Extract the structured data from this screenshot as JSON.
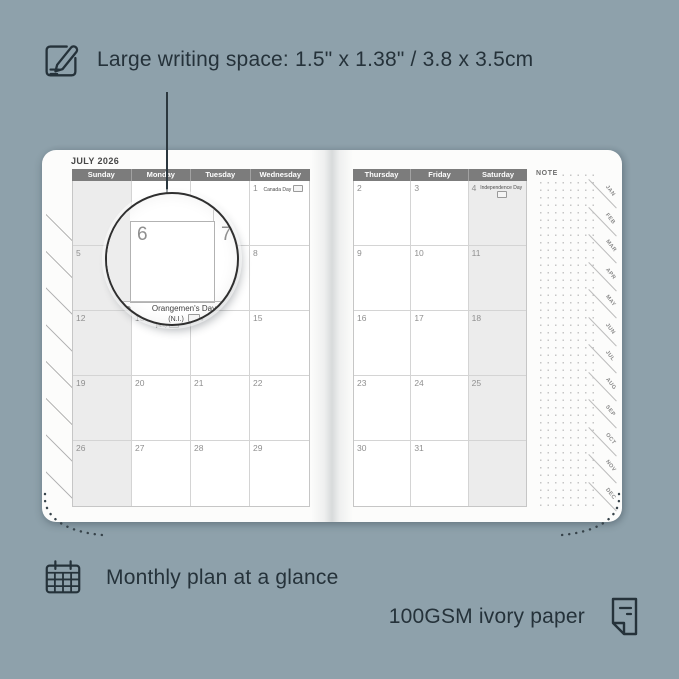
{
  "colors": {
    "background": "#8ea1ab",
    "page": "#fcfcfb",
    "header_bar": "#7c7c7c",
    "shaded_column": "#ececec",
    "annotation_text": "#25323a"
  },
  "annotations": {
    "top": {
      "text": "Large writing space: 1.5\" x 1.38\" / 3.8 x 3.5cm"
    },
    "bottom_left": {
      "text": "Monthly plan at a glance"
    },
    "bottom_right": {
      "text": "100GSM ivory paper"
    }
  },
  "planner": {
    "title": "JULY 2026",
    "note_label": "NOTE",
    "month_tabs": [
      "JAN",
      "FEB",
      "MAR",
      "APR",
      "MAY",
      "JUN",
      "JUL",
      "AUG",
      "SEP",
      "OCT",
      "NOV",
      "DEC"
    ],
    "left_page": {
      "headers": [
        "Sunday",
        "Monday",
        "Tuesday",
        "Wednesday"
      ],
      "shaded_column": 0,
      "rows": [
        [
          {
            "day": ""
          },
          {
            "day": ""
          },
          {
            "day": ""
          },
          {
            "day": "1",
            "holiday": "Canada Day"
          }
        ],
        [
          {
            "day": "5"
          },
          {
            "day": "6"
          },
          {
            "day": "7"
          },
          {
            "day": "8"
          }
        ],
        [
          {
            "day": "12"
          },
          {
            "day": "13",
            "holiday": "Orangemen's Day (N.I.)"
          },
          {
            "day": "14"
          },
          {
            "day": "15"
          }
        ],
        [
          {
            "day": "19"
          },
          {
            "day": "20"
          },
          {
            "day": "21"
          },
          {
            "day": "22"
          }
        ],
        [
          {
            "day": "26"
          },
          {
            "day": "27"
          },
          {
            "day": "28"
          },
          {
            "day": "29"
          }
        ]
      ]
    },
    "right_page": {
      "headers": [
        "Thursday",
        "Friday",
        "Saturday"
      ],
      "shaded_column": 2,
      "rows": [
        [
          {
            "day": "2"
          },
          {
            "day": "3"
          },
          {
            "day": "4",
            "holiday": "Independence Day"
          }
        ],
        [
          {
            "day": "9"
          },
          {
            "day": "10"
          },
          {
            "day": "11"
          }
        ],
        [
          {
            "day": "16"
          },
          {
            "day": "17"
          },
          {
            "day": "18"
          }
        ],
        [
          {
            "day": "23"
          },
          {
            "day": "24"
          },
          {
            "day": "25"
          }
        ],
        [
          {
            "day": "30"
          },
          {
            "day": "31"
          },
          {
            "day": ""
          }
        ]
      ]
    },
    "magnifier": {
      "focus_day": "6",
      "adjacent_day": "7",
      "below_day": "13",
      "below_holiday_line1": "Orangemen's Day",
      "below_holiday_line2": "(N.I.)"
    }
  }
}
